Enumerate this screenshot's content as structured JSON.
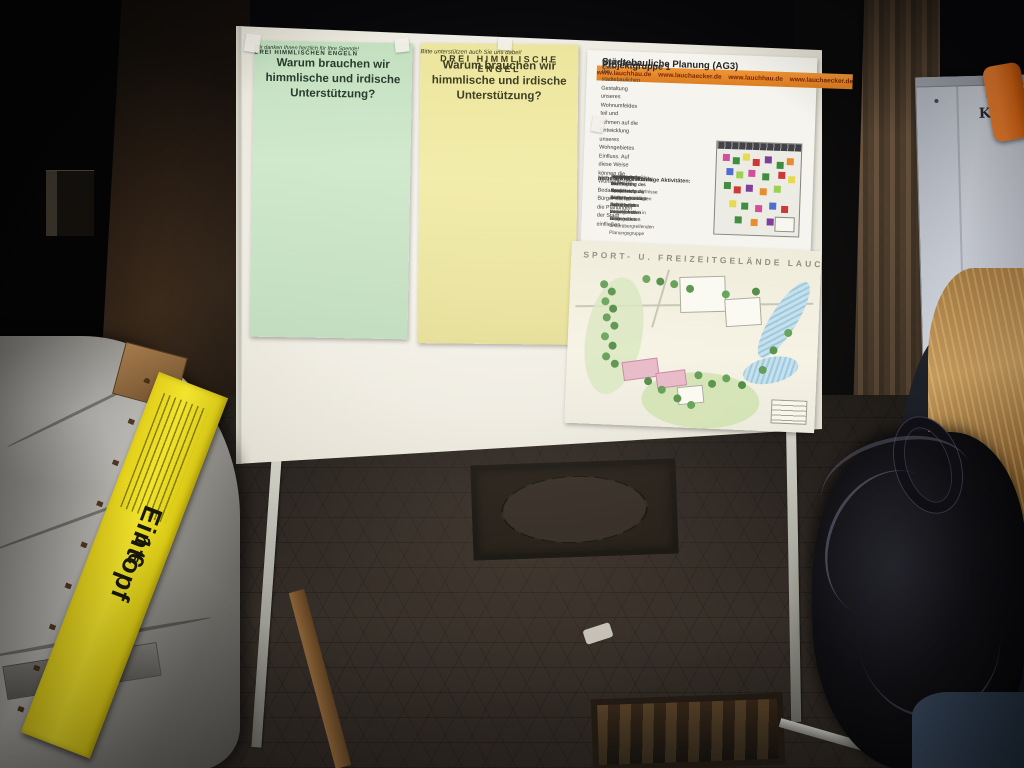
{
  "posters": {
    "green": {
      "title": "Warum brauchen wir himmlische und irdische Unterstützung?",
      "highlight": "DREI HIMMLISCHEN ENGELN",
      "footer": "Wir danken Ihnen herzlich für Ihre Spende!"
    },
    "yellow": {
      "title": "Warum brauchen wir himmlische und irdische Unterstützung?",
      "highlight": "DREI HIMMLISCHE ENGEL",
      "footer": "Bitte unterstützen auch Sie uns dabei!"
    },
    "project": {
      "banner": "www.lauchhau.de  www.lauchaecker.de  www.lauchhau.de  www.lauchaecker.de",
      "group": "Projektgruppe 1",
      "subtitle": "Städtebauliche Planung (AG3)",
      "goals_label": "unsere Ziele:",
      "goals_text": "Wir nehmen an der städtebaulichen Gestaltung unseres Wohnumfeldes teil und nehmen auf die Entwicklung unseres Wohngebietes Einfluss. Auf diese Weise können die Wünsche und Bedarfe der Bürger mit in die Planungen der Stadt einfließen.",
      "past_label": "bisherige Aktivitäten:",
      "past_items": [
        "Durchsetzung der korrekten Ausweisung der verkehrsberuhigten Bereiche im Lauchäcker",
        "Erarbeiten einer Intensivnutzung des Grünstreifens zwischen den Wohngebieten"
      ],
      "future_label": "aktuelle und zukünftige Aktivitäten:",
      "future_items": [
        "Beteiligung bei der Planung der neuen Kindertagesstätte mit ausreichenden Bürgerräumen",
        "Gemeinsame Planung der Gemeindebedürfnisse im Grünstreifen zwischen den Wohngebieten in einer ämterübergreifenden Planungsgruppe",
        "Mitwirkung bei der Planung des Sport- und Freizeitgeländes Lauchäcker",
        "Fertigstellung des Bolzplatzes mit Ballfangzaun im Grünstreifen"
      ]
    },
    "siteplan": {
      "title": "SPORT- U. FREIZEITGELÄNDE LAUCHÄCKER"
    }
  },
  "food_sign": {
    "text": "Eintopf",
    "price": "1 €"
  },
  "flipchart": {
    "label": "Kling"
  },
  "colors": {
    "poster_green": "#cbe5c6",
    "poster_yellow": "#efe8a2",
    "banner_orange": "#e2862f",
    "sign_yellow": "#ecd920",
    "clamp_orange": "#df6a16"
  }
}
